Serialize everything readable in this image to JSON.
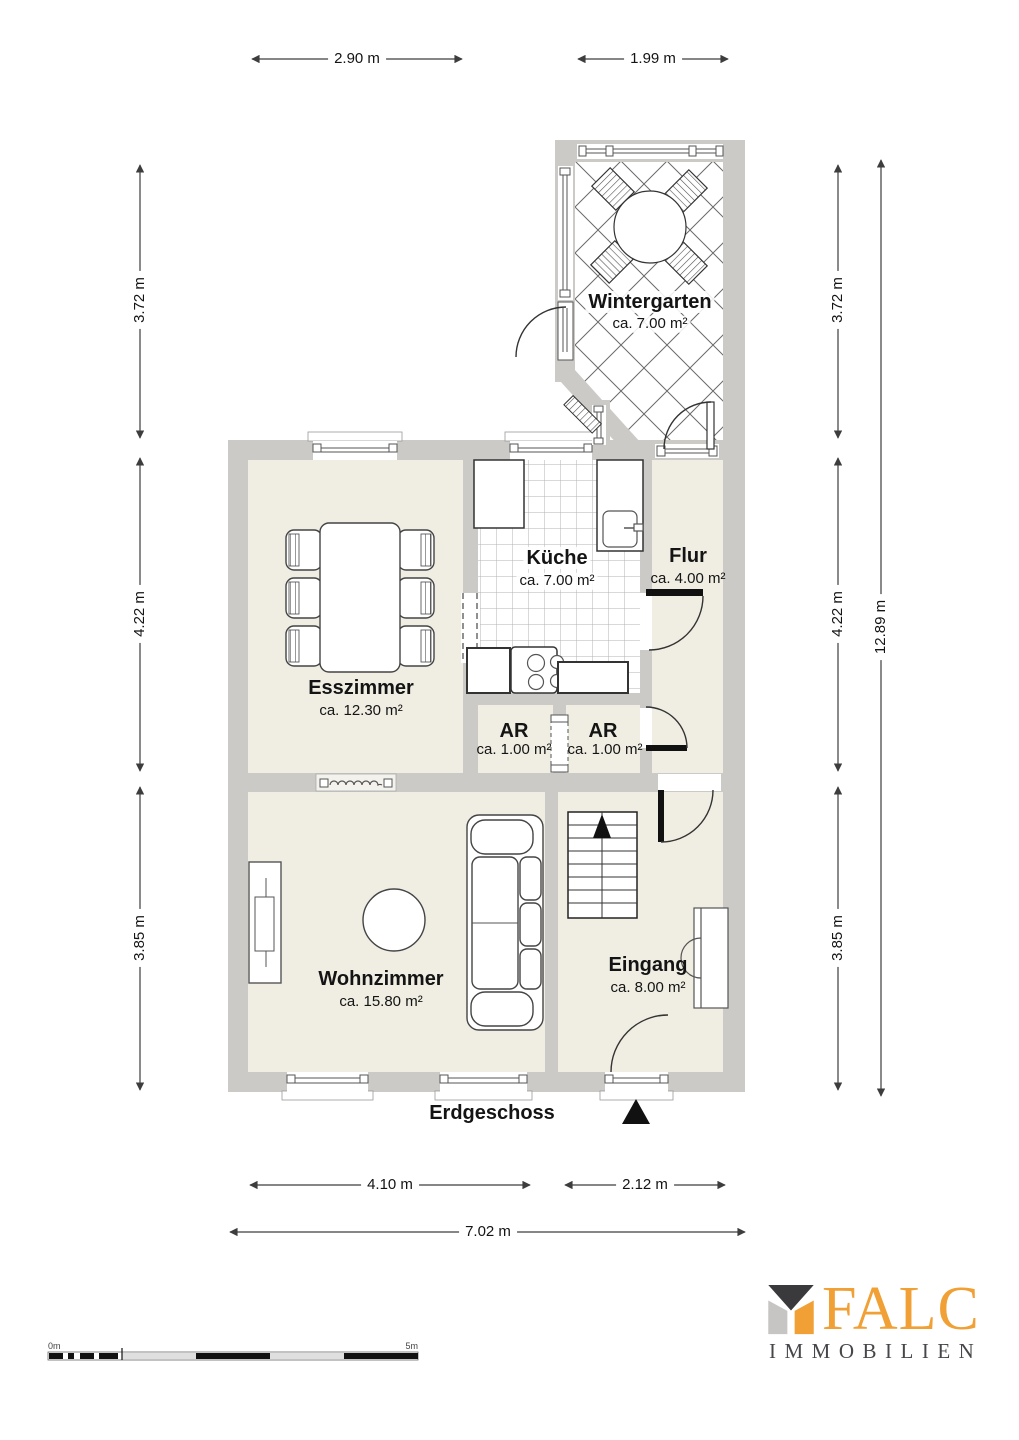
{
  "floor_label": "Erdgeschoss",
  "rooms": {
    "wintergarten": {
      "name": "Wintergarten",
      "area": "ca. 7.00 m²"
    },
    "kueche": {
      "name": "Küche",
      "area": "ca. 7.00 m²"
    },
    "flur": {
      "name": "Flur",
      "area": "ca. 4.00 m²"
    },
    "esszimmer": {
      "name": "Esszimmer",
      "area": "ca. 12.30 m²"
    },
    "ar_left": {
      "name": "AR",
      "area": "ca. 1.00 m²"
    },
    "ar_right": {
      "name": "AR",
      "area": "ca. 1.00 m²"
    },
    "wohnzimmer": {
      "name": "Wohnzimmer",
      "area": "ca. 15.80 m²"
    },
    "eingang": {
      "name": "Eingang",
      "area": "ca. 8.00 m²"
    }
  },
  "dimensions": {
    "top_left": "2.90 m",
    "top_right": "1.99 m",
    "left_upper": "3.72 m",
    "left_middle": "4.22 m",
    "left_lower": "3.85 m",
    "right_upper": "3.72 m",
    "right_middle": "4.22 m",
    "right_lower": "3.85 m",
    "right_total": "12.89 m",
    "bottom_living": "4.10 m",
    "bottom_entrance": "2.12 m",
    "bottom_total": "7.02 m"
  },
  "scale_bar": {
    "start_label": "0m",
    "end_label": "5m"
  },
  "logo": {
    "brand": "FALC",
    "subtitle": "IMMOBILIEN"
  },
  "colors": {
    "wall": "#CBCAC7",
    "floor": "#F0EEE3",
    "line": "#3d3d3d",
    "brand_orange": "#F0A035",
    "brand_dark": "#3A393B",
    "brand_light": "#C6C5C3"
  }
}
